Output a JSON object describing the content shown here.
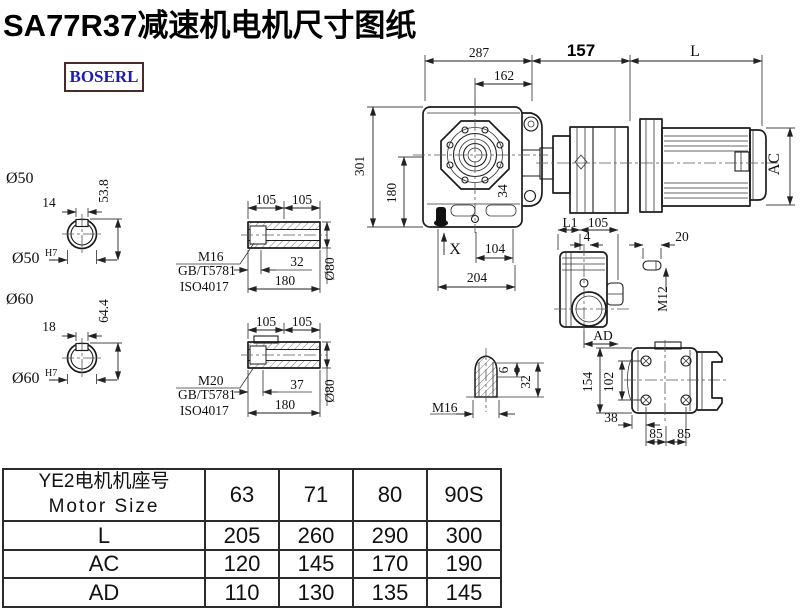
{
  "title": "SA77R37减速机电机尺寸图纸",
  "logo": "BOSERL",
  "drawing": {
    "top_dims": {
      "d287": "287",
      "d162": "162",
      "d157": "157",
      "dL": "L"
    },
    "main_view": {
      "d301": "301",
      "d180": "180",
      "d34": "34",
      "dX": "X",
      "d104": "104",
      "d204": "204",
      "dAC": "AC"
    },
    "shaft50": {
      "dia": "Ø50",
      "key_w": "14",
      "key_h": "53.8",
      "fit": "Ø50",
      "fit_sup": "H7"
    },
    "shaft60": {
      "dia": "Ø60",
      "key_w": "18",
      "key_h": "64.4",
      "fit": "Ø60",
      "fit_sup": "H7"
    },
    "hollow_shaft_top": {
      "d105a": "105",
      "d105b": "105",
      "bolt": "M16",
      "std1": "GB/T5781",
      "std2": "ISO4017",
      "d32": "32",
      "d180": "180",
      "d80": "Ø80"
    },
    "hollow_shaft_bottom": {
      "d105a": "105",
      "d105b": "105",
      "bolt": "M20",
      "std1": "GB/T5781",
      "std2": "ISO4017",
      "d37": "37",
      "d180": "180",
      "d80": "Ø80"
    },
    "side_view": {
      "dL1": "L1",
      "d105": "105",
      "d4": "4",
      "dAD": "AD",
      "d20": "20",
      "dM12": "M12"
    },
    "back_view": {
      "d154": "154",
      "d102": "102",
      "d38": "38",
      "d85a": "85",
      "d85b": "85"
    },
    "plug_detail": {
      "dM16": "M16",
      "d6": "6",
      "d32": "32"
    }
  },
  "table": {
    "header": {
      "line1": "YE2电机机座号",
      "line2": "Motor Size",
      "cols": [
        "63",
        "71",
        "80",
        "90S"
      ]
    },
    "rows": [
      {
        "label": "L",
        "values": [
          "205",
          "260",
          "290",
          "300"
        ]
      },
      {
        "label": "AC",
        "values": [
          "120",
          "145",
          "170",
          "190"
        ]
      },
      {
        "label": "AD",
        "values": [
          "110",
          "130",
          "135",
          "145"
        ]
      }
    ]
  }
}
